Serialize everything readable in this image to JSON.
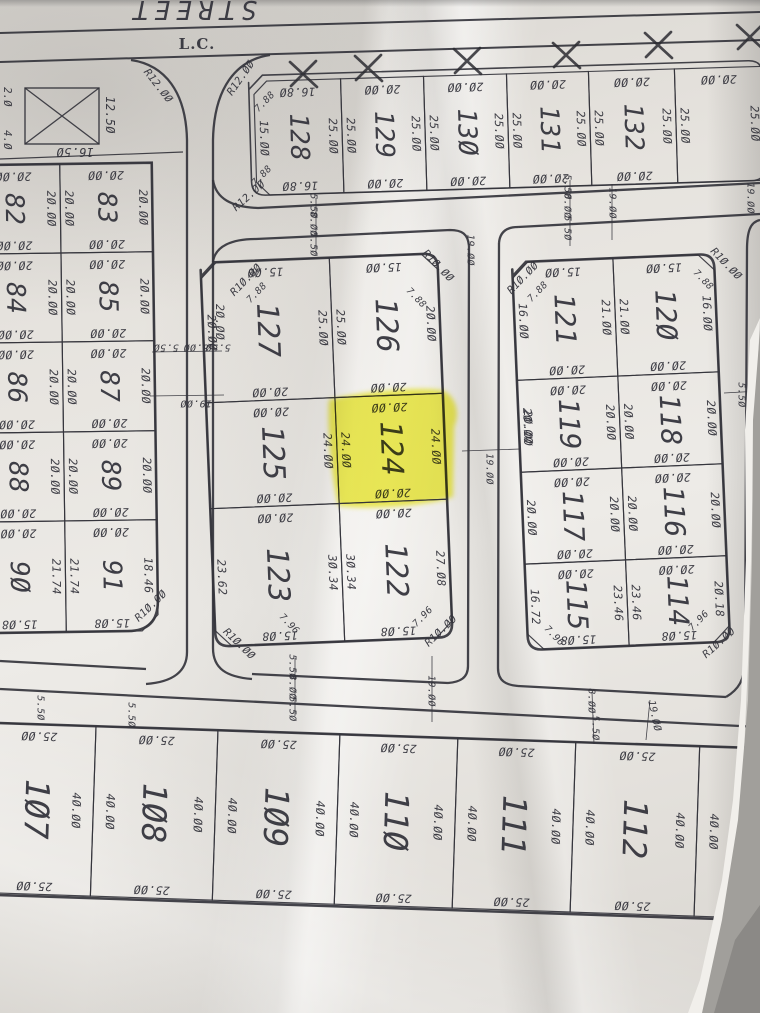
{
  "document": {
    "street_label": "STREET",
    "corner_label": "L.C.",
    "highlighted_lot": "124",
    "highlight_color": "#f0ee2c",
    "ink_color": "#34343c",
    "paper_color": "#e7e4df"
  },
  "reserved_plot": {
    "dims": {
      "left_top": "2.0",
      "left_bottom": "4.0",
      "right": "12.50",
      "bottom": "16.50"
    }
  },
  "blocks": [
    {
      "id": "top-row",
      "tilt": -1.7,
      "cx": 505,
      "cy": 126,
      "stroke": "med",
      "outline": {
        "x": 250,
        "y": 68,
        "w": 514,
        "h": 120,
        "r": 14
      },
      "num_size": 26,
      "lots": [
        {
          "no": "128",
          "x": 255,
          "y": 74,
          "w": 87,
          "h": 114,
          "t": "16.80",
          "r": "25.00",
          "b": "16.80",
          "l": "15.00",
          "cut": [
            "tl",
            "bl"
          ]
        },
        {
          "no": "129",
          "x": 342,
          "y": 74,
          "w": 83,
          "h": 114,
          "t": "20.00",
          "r": "25.00",
          "b": "20.00",
          "l": "25.00"
        },
        {
          "no": "130",
          "x": 425,
          "y": 74,
          "w": 83,
          "h": 114,
          "t": "20.00",
          "r": "25.00",
          "b": "20.00",
          "l": "25.00"
        },
        {
          "no": "131",
          "x": 508,
          "y": 74,
          "w": 82,
          "h": 114,
          "t": "20.00",
          "r": "25.00",
          "b": "20.00",
          "l": "25.00"
        },
        {
          "no": "132",
          "x": 590,
          "y": 74,
          "w": 86,
          "h": 114,
          "t": "20.00",
          "r": "25.00",
          "b": "20.00",
          "l": "25.00"
        },
        {
          "no": "",
          "x": 676,
          "y": 74,
          "w": 88,
          "h": 114,
          "t": "20.00",
          "r": "25.00",
          "l": "25.00"
        }
      ]
    },
    {
      "id": "left",
      "tilt": -0.8,
      "cx": 62,
      "cy": 398,
      "stroke": "heavy",
      "outline": {
        "x": -30,
        "y": 164,
        "w": 185,
        "h": 468,
        "r": 0,
        "round_br": 30
      },
      "num_size": 26,
      "lots": [
        {
          "no": "82",
          "x": -30,
          "y": 164,
          "w": 93,
          "h": 89,
          "t": "20.00",
          "r": "20.00",
          "b": "20.00"
        },
        {
          "no": "83",
          "x": 63,
          "y": 164,
          "w": 92,
          "h": 89,
          "t": "20.00",
          "r": "20.00",
          "b": "20.00",
          "l": "20.00"
        },
        {
          "no": "84",
          "x": -30,
          "y": 253,
          "w": 93,
          "h": 89,
          "t": "20.00",
          "r": "20.00",
          "b": "20.00"
        },
        {
          "no": "85",
          "x": 63,
          "y": 253,
          "w": 92,
          "h": 89,
          "t": "20.00",
          "r": "20.00",
          "b": "20.00",
          "l": "20.00"
        },
        {
          "no": "86",
          "x": -30,
          "y": 342,
          "w": 93,
          "h": 90,
          "t": "20.00",
          "r": "20.00",
          "b": "20.00"
        },
        {
          "no": "87",
          "x": 63,
          "y": 342,
          "w": 92,
          "h": 90,
          "t": "20.00",
          "r": "20.00",
          "b": "20.00",
          "l": "20.00"
        },
        {
          "no": "88",
          "x": -30,
          "y": 432,
          "w": 93,
          "h": 89,
          "t": "20.00",
          "r": "20.00",
          "b": "20.00"
        },
        {
          "no": "89",
          "x": 63,
          "y": 432,
          "w": 92,
          "h": 89,
          "t": "20.00",
          "r": "20.00",
          "b": "20.00",
          "l": "20.00"
        },
        {
          "no": "90",
          "x": -30,
          "y": 521,
          "w": 93,
          "h": 111,
          "t": "20.00",
          "r": "21.74",
          "b": "15.08"
        },
        {
          "no": "91",
          "x": 63,
          "y": 521,
          "w": 92,
          "h": 111,
          "t": "20.00",
          "r": "18.46",
          "b": "15.08",
          "l": "21.74",
          "cut": [
            "br"
          ]
        }
      ]
    },
    {
      "id": "middle",
      "tilt": -2.3,
      "cx": 326,
      "cy": 450,
      "stroke": "heavy",
      "outline": {
        "x": 208,
        "y": 258,
        "w": 237,
        "h": 384,
        "r": 14
      },
      "num_size": 30,
      "lots": [
        {
          "no": "127",
          "x": 208,
          "y": 258,
          "w": 129,
          "h": 140,
          "t": "15.00",
          "r": "25.00",
          "b": "20.00",
          "l": "20.00",
          "cut": [
            "tl"
          ]
        },
        {
          "no": "126",
          "x": 337,
          "y": 258,
          "w": 108,
          "h": 140,
          "t": "15.00",
          "r": "20.00",
          "b": "20.00",
          "l": "25.00",
          "cut": [
            "tr"
          ]
        },
        {
          "no": "125",
          "x": 208,
          "y": 398,
          "w": 129,
          "h": 106,
          "t": "20.00",
          "r": "24.00",
          "b": "20.00"
        },
        {
          "no": "124",
          "x": 337,
          "y": 398,
          "w": 108,
          "h": 106,
          "t": "20.00",
          "r": "24.00",
          "b": "20.00",
          "l": "24.00",
          "highlight": true
        },
        {
          "no": "123",
          "x": 208,
          "y": 504,
          "w": 129,
          "h": 138,
          "t": "20.00",
          "r": "30.34",
          "b": "15.08",
          "l": "23.62",
          "cut": [
            "bl"
          ]
        },
        {
          "no": "122",
          "x": 337,
          "y": 504,
          "w": 108,
          "h": 138,
          "t": "20.00",
          "r": "27.08",
          "b": "15.08",
          "l": "30.34",
          "cut": [
            "br"
          ]
        }
      ]
    },
    {
      "id": "right",
      "tilt": -2.4,
      "cx": 621,
      "cy": 452,
      "stroke": "heavy",
      "outline": {
        "x": 520,
        "y": 258,
        "w": 202,
        "h": 388,
        "r": 14
      },
      "num_size": 28,
      "lots": [
        {
          "no": "121",
          "x": 520,
          "y": 258,
          "w": 101,
          "h": 118,
          "t": "15.00",
          "r": "21.00",
          "b": "20.00",
          "l": "16.00",
          "cut": [
            "tl"
          ]
        },
        {
          "no": "120",
          "x": 621,
          "y": 258,
          "w": 101,
          "h": 118,
          "t": "15.00",
          "r": "16.00",
          "b": "20.00",
          "l": "21.00",
          "cut": [
            "tr"
          ]
        },
        {
          "no": "119",
          "x": 520,
          "y": 376,
          "w": 101,
          "h": 92,
          "t": "20.00",
          "r": "20.00",
          "b": "20.00",
          "l": "20.00"
        },
        {
          "no": "118",
          "x": 621,
          "y": 376,
          "w": 101,
          "h": 92,
          "t": "20.00",
          "r": "20.00",
          "b": "20.00",
          "l": "20.00"
        },
        {
          "no": "117",
          "x": 520,
          "y": 468,
          "w": 101,
          "h": 92,
          "t": "20.00",
          "r": "20.00",
          "b": "20.00",
          "l": "20.00"
        },
        {
          "no": "116",
          "x": 621,
          "y": 468,
          "w": 101,
          "h": 92,
          "t": "20.00",
          "r": "20.00",
          "b": "20.00",
          "l": "20.00"
        },
        {
          "no": "115",
          "x": 520,
          "y": 560,
          "w": 101,
          "h": 86,
          "t": "20.00",
          "r": "23.46",
          "b": "15.08",
          "l": "16.72",
          "cut": [
            "bl"
          ]
        },
        {
          "no": "114",
          "x": 621,
          "y": 560,
          "w": 101,
          "h": 86,
          "t": "20.00",
          "r": "20.18",
          "b": "15.08",
          "l": "23.46",
          "cut": [
            "br"
          ]
        }
      ]
    },
    {
      "id": "bottom",
      "tilt": 1.9,
      "cx": 390,
      "cy": 822,
      "stroke": "heavy",
      "outline": {
        "x": -24,
        "y": 736,
        "w": 828,
        "h": 172,
        "r": 8
      },
      "num_size": 33,
      "lots": [
        {
          "no": "107",
          "x": -20,
          "y": 736,
          "w": 113,
          "h": 170,
          "t": "25.00",
          "r": "40.00",
          "b": "25.00"
        },
        {
          "no": "108",
          "x": 93,
          "y": 736,
          "w": 122,
          "h": 170,
          "t": "25.00",
          "r": "40.00",
          "b": "25.00",
          "l": "40.00"
        },
        {
          "no": "109",
          "x": 215,
          "y": 736,
          "w": 122,
          "h": 170,
          "t": "25.00",
          "r": "40.00",
          "b": "25.00",
          "l": "40.00"
        },
        {
          "no": "110",
          "x": 337,
          "y": 736,
          "w": 118,
          "h": 170,
          "t": "25.00",
          "r": "40.00",
          "b": "25.00",
          "l": "40.00"
        },
        {
          "no": "111",
          "x": 455,
          "y": 736,
          "w": 118,
          "h": 170,
          "t": "25.00",
          "r": "40.00",
          "b": "25.00",
          "l": "40.00"
        },
        {
          "no": "112",
          "x": 573,
          "y": 736,
          "w": 124,
          "h": 170,
          "t": "25.00",
          "r": "40.00",
          "b": "25.00",
          "l": "40.00"
        },
        {
          "no": "113",
          "x": 697,
          "y": 736,
          "w": 95,
          "h": 170,
          "l": "40.00"
        }
      ]
    }
  ],
  "annotations": [
    {
      "kind": "street-name",
      "text": "STREET",
      "x": 192,
      "y": 9,
      "rot": 180,
      "size": 26
    },
    {
      "kind": "corner-note",
      "text": "L.C.",
      "x": 197,
      "y": 44,
      "rot": 0,
      "size": 15
    },
    {
      "kind": "reserved-dim",
      "text": "12.50",
      "x": 110,
      "y": 115,
      "rot": 90,
      "size": 12
    },
    {
      "kind": "reserved-dim",
      "text": "16.50",
      "x": 75,
      "y": 152,
      "rot": 180,
      "size": 12
    },
    {
      "kind": "reserved-dim",
      "text": "2.0",
      "x": 7,
      "y": 97,
      "rot": 90,
      "size": 10.5
    },
    {
      "kind": "reserved-dim",
      "text": "4.0",
      "x": 7,
      "y": 140,
      "rot": 90,
      "size": 10.5
    },
    {
      "kind": "radius",
      "text": "R12.00",
      "x": 158,
      "y": 86,
      "rot": 52,
      "size": 10.5
    },
    {
      "kind": "radius",
      "text": "R12.00",
      "x": 241,
      "y": 78,
      "rot": -55,
      "size": 10.5
    },
    {
      "kind": "radius",
      "text": "R12.00",
      "x": 249,
      "y": 196,
      "rot": -42,
      "size": 10.5
    },
    {
      "kind": "radius",
      "text": "R10.00",
      "x": 246,
      "y": 280,
      "rot": -46,
      "size": 10.5
    },
    {
      "kind": "radius",
      "text": "R10.00",
      "x": 438,
      "y": 266,
      "rot": 46,
      "size": 10.5
    },
    {
      "kind": "radius",
      "text": "R10.00",
      "x": 239,
      "y": 644,
      "rot": 44,
      "size": 10.5
    },
    {
      "kind": "radius",
      "text": "R10.00",
      "x": 441,
      "y": 631,
      "rot": -44,
      "size": 10.5
    },
    {
      "kind": "radius",
      "text": "R10.00",
      "x": 523,
      "y": 278,
      "rot": -46,
      "size": 10.5
    },
    {
      "kind": "radius",
      "text": "R10.00",
      "x": 726,
      "y": 264,
      "rot": 46,
      "size": 10.5
    },
    {
      "kind": "radius",
      "text": "R10.00",
      "x": 719,
      "y": 643,
      "rot": -42,
      "size": 10.5
    },
    {
      "kind": "radius",
      "text": "R10.00",
      "x": 151,
      "y": 606,
      "rot": -44,
      "size": 10.5
    },
    {
      "kind": "chamfer",
      "text": "7.88",
      "x": 265,
      "y": 102,
      "rot": -46,
      "size": 9.5
    },
    {
      "kind": "chamfer",
      "text": "7.88",
      "x": 262,
      "y": 176,
      "rot": -46,
      "size": 9.5
    },
    {
      "kind": "chamfer",
      "text": "7.88",
      "x": 257,
      "y": 293,
      "rot": -46,
      "size": 9.5
    },
    {
      "kind": "chamfer",
      "text": "7.88",
      "x": 416,
      "y": 298,
      "rot": 46,
      "size": 9.5
    },
    {
      "kind": "chamfer",
      "text": "7.88",
      "x": 538,
      "y": 292,
      "rot": -46,
      "size": 9.5
    },
    {
      "kind": "chamfer",
      "text": "7.88",
      "x": 703,
      "y": 280,
      "rot": 46,
      "size": 9.5
    },
    {
      "kind": "chamfer",
      "text": "7.96",
      "x": 289,
      "y": 624,
      "rot": 46,
      "size": 9.5
    },
    {
      "kind": "chamfer",
      "text": "7.96",
      "x": 423,
      "y": 617,
      "rot": -46,
      "size": 9.5
    },
    {
      "kind": "chamfer",
      "text": "7.96",
      "x": 554,
      "y": 636,
      "rot": 46,
      "size": 9.5
    },
    {
      "kind": "chamfer",
      "text": "7.96",
      "x": 699,
      "y": 621,
      "rot": -46,
      "size": 9.5
    },
    {
      "kind": "street-dim",
      "text": "5.50",
      "x": 313,
      "y": 206,
      "rot": 90,
      "size": 10
    },
    {
      "kind": "street-dim",
      "text": "8.00",
      "x": 313,
      "y": 224,
      "rot": 90,
      "size": 10
    },
    {
      "kind": "street-dim",
      "text": "5.50",
      "x": 313,
      "y": 244,
      "rot": 90,
      "size": 10
    },
    {
      "kind": "street-dim",
      "text": "5.50",
      "x": 567,
      "y": 187,
      "rot": 90,
      "size": 10
    },
    {
      "kind": "street-dim",
      "text": "8.00",
      "x": 567,
      "y": 206,
      "rot": 90,
      "size": 10
    },
    {
      "kind": "street-dim",
      "text": "5.50",
      "x": 567,
      "y": 228,
      "rot": 90,
      "size": 10
    },
    {
      "kind": "street-dim",
      "text": "19.00",
      "x": 612,
      "y": 203,
      "rot": 90,
      "size": 10
    },
    {
      "kind": "street-dim",
      "text": "19.00",
      "x": 470,
      "y": 250,
      "rot": 90,
      "size": 10
    },
    {
      "kind": "street-dim",
      "text": "19.00",
      "x": 750,
      "y": 198,
      "rot": 90,
      "size": 10
    },
    {
      "kind": "street-dim",
      "text": "5.50",
      "x": 166,
      "y": 347,
      "rot": 180,
      "size": 10
    },
    {
      "kind": "street-dim",
      "text": "8.00",
      "x": 196,
      "y": 347,
      "rot": 180,
      "size": 10
    },
    {
      "kind": "street-dim",
      "text": "5.50",
      "x": 218,
      "y": 347,
      "rot": 180,
      "size": 10
    },
    {
      "kind": "street-dim",
      "text": "19.00",
      "x": 196,
      "y": 403,
      "rot": 180,
      "size": 10
    },
    {
      "kind": "street-dim",
      "text": "19.00",
      "x": 489,
      "y": 469,
      "rot": 90,
      "size": 10
    },
    {
      "kind": "street-dim",
      "text": "5.50",
      "x": 741,
      "y": 395,
      "rot": 90,
      "size": 10
    },
    {
      "kind": "street-dim",
      "text": "19.00",
      "x": 752,
      "y": 462,
      "rot": 90,
      "size": 10
    },
    {
      "kind": "street-dim",
      "text": "5.50",
      "x": 292,
      "y": 667,
      "rot": 90,
      "size": 10
    },
    {
      "kind": "street-dim",
      "text": "8.00",
      "x": 292,
      "y": 687,
      "rot": 90,
      "size": 10
    },
    {
      "kind": "street-dim",
      "text": "5.50",
      "x": 292,
      "y": 709,
      "rot": 90,
      "size": 10
    },
    {
      "kind": "street-dim",
      "text": "19.00",
      "x": 431,
      "y": 691,
      "rot": 90,
      "size": 10
    },
    {
      "kind": "street-dim",
      "text": "8.00",
      "x": 591,
      "y": 701,
      "rot": 90,
      "size": 10
    },
    {
      "kind": "street-dim",
      "text": "5.50",
      "x": 595,
      "y": 728,
      "rot": 90,
      "size": 10
    },
    {
      "kind": "street-dim",
      "text": "19.00",
      "x": 654,
      "y": 716,
      "rot": 78,
      "size": 10
    },
    {
      "kind": "street-dim",
      "text": "5.50",
      "x": 40,
      "y": 708,
      "rot": 90,
      "size": 10
    },
    {
      "kind": "street-dim",
      "text": "5.50",
      "x": 131,
      "y": 715,
      "rot": 90,
      "size": 10
    },
    {
      "kind": "dim",
      "text": "20.00",
      "x": 220,
      "y": 322,
      "rot": 90,
      "size": 11.5
    },
    {
      "kind": "dim",
      "text": "20.00",
      "x": 528,
      "y": 428,
      "rot": 90,
      "size": 11.5
    }
  ],
  "x_marks": [
    {
      "x": 303,
      "y": 74
    },
    {
      "x": 368,
      "y": 68
    },
    {
      "x": 467,
      "y": 61
    },
    {
      "x": 566,
      "y": 55
    },
    {
      "x": 658,
      "y": 45
    },
    {
      "x": 750,
      "y": 37
    }
  ]
}
